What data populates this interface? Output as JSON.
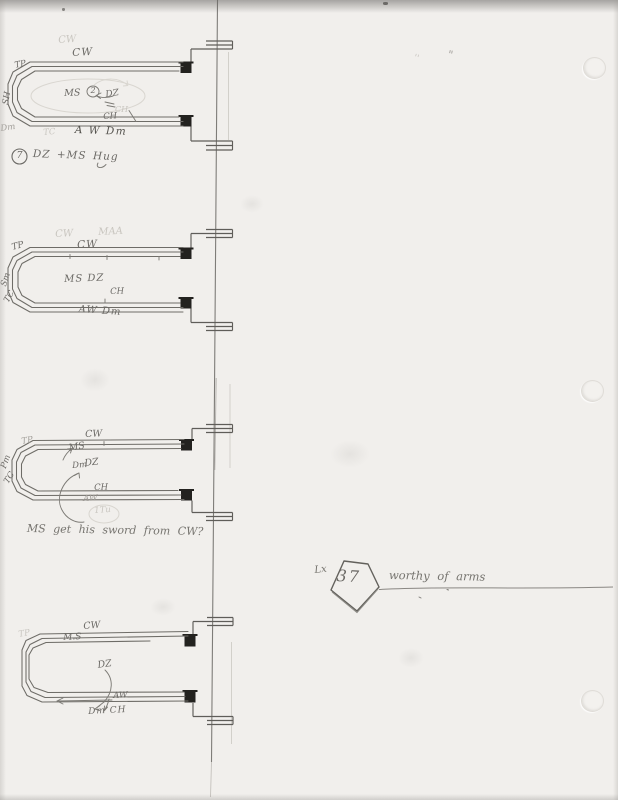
{
  "paper": {
    "margin_mark_left": "''",
    "margin_mark_right": "\""
  },
  "loops": [
    {
      "ghost_top": "CW",
      "top": "CW",
      "corner": "TP",
      "side": "SH",
      "center": "MS",
      "circled": "2",
      "partner": "DZ",
      "ghost_line": "CH",
      "line": "CH",
      "bottom": "A W Dm",
      "ghost_bottom_left": "Dm",
      "ghost_bottom_mid": "TC",
      "caption_num": "7",
      "caption": "DZ +MS Hug"
    },
    {
      "ghost_top": "CW",
      "ghost_top2": "MAA",
      "top": "CW",
      "corner": "TP",
      "side": "Sm",
      "side2": "TC",
      "center": "MS DZ",
      "line": "CH",
      "bottom": "AW Dm"
    },
    {
      "top": "CW",
      "corner": "TP",
      "side": "Pm",
      "side2": "TC",
      "center": "MS",
      "partner": "DZ",
      "mover": "Dm",
      "line": "CH",
      "bottom": "AW",
      "ghost_circled": "1Tu",
      "note": "MS get his sword from CW?"
    },
    {
      "top": "CW",
      "second": "M.S",
      "corner": "TP",
      "partner": "DZ",
      "line_label": "AW",
      "below": "Dm CH"
    }
  ],
  "cue": {
    "prefix": "Lx",
    "number": "37",
    "title": "worthy of arms"
  }
}
